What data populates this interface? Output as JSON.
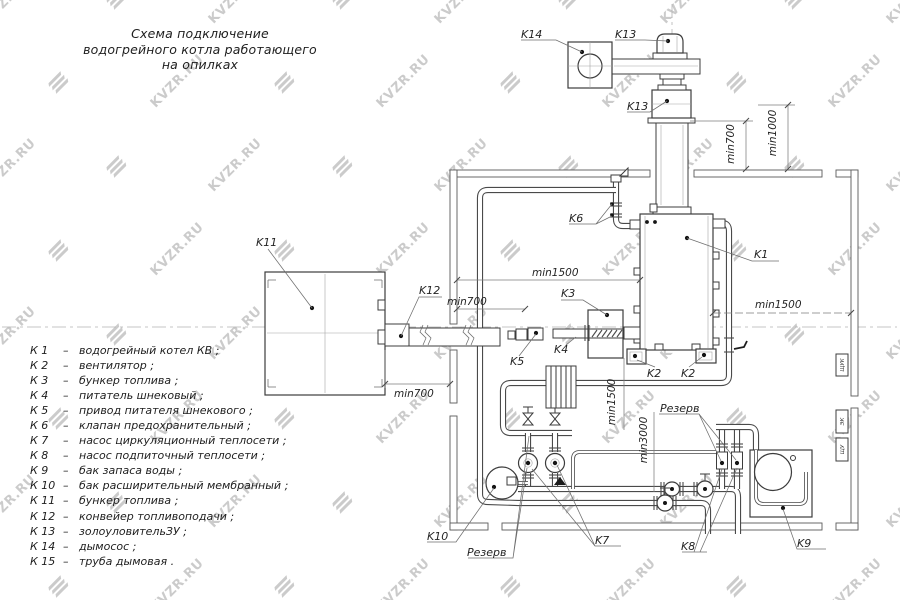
{
  "watermark": {
    "text": "KVZR.RU"
  },
  "title": {
    "lines": [
      "Схема подключение",
      "водогрейного котла работающего",
      "на опилках"
    ]
  },
  "legend": {
    "items": [
      {
        "key": "К 1",
        "sep": "–",
        "desc": "водогрейный котел КВ ;"
      },
      {
        "key": "К 2",
        "sep": "–",
        "desc": "вентилятор ;"
      },
      {
        "key": "К 3",
        "sep": "–",
        "desc": "бункер топлива ;"
      },
      {
        "key": "К 4",
        "sep": "–",
        "desc": "питатель шнековый ;"
      },
      {
        "key": "К 5",
        "sep": "–",
        "desc": "привод питателя шнекового ;"
      },
      {
        "key": "К 6",
        "sep": "–",
        "desc": "клапан предохранительный ;"
      },
      {
        "key": "К 7",
        "sep": "–",
        "desc": "насос циркуляционный теплосети ;"
      },
      {
        "key": "К 8",
        "sep": "–",
        "desc": "насос подпиточный теплосети ;"
      },
      {
        "key": "К 9",
        "sep": "–",
        "desc": "бак запаса воды ;"
      },
      {
        "key": "К 10",
        "sep": "–",
        "desc": "бак расширительный мембранный ;"
      },
      {
        "key": "К 11",
        "sep": "–",
        "desc": "бункер топлива ;"
      },
      {
        "key": "К 12",
        "sep": "–",
        "desc": "конвейер топливоподачи ;"
      },
      {
        "key": "К 13",
        "sep": "–",
        "desc": "золоуловительЗУ ;"
      },
      {
        "key": "К 14",
        "sep": "–",
        "desc": "дымосос ;"
      },
      {
        "key": "К 15",
        "sep": "–",
        "desc": "труба дымовая ."
      }
    ]
  },
  "diagram": {
    "labels": {
      "k14": "K14",
      "k13_top": "K13",
      "k13_mid": "K13",
      "k6": "K6",
      "k1": "K1",
      "k11": "K11",
      "k12": "K12",
      "k3": "K3",
      "k5": "K5",
      "k4": "K4",
      "k2_left": "K2",
      "k2_right": "K2",
      "k10": "K10",
      "k7": "K7",
      "k8": "K8",
      "k9": "K9",
      "reserve_left": "Резерв",
      "reserve_right": "Резерв"
    },
    "dims": {
      "min700_chimney": "min700",
      "min1000": "min1000",
      "min1500_left": "min1500",
      "min700_feeder": "min700",
      "min700_conveyor": "min700",
      "min1500_right": "min1500",
      "min1500_vert": "min1500",
      "min3000": "min3000"
    },
    "cabinets": [
      "ЩУК",
      "ЭК",
      "ЩУ"
    ]
  }
}
